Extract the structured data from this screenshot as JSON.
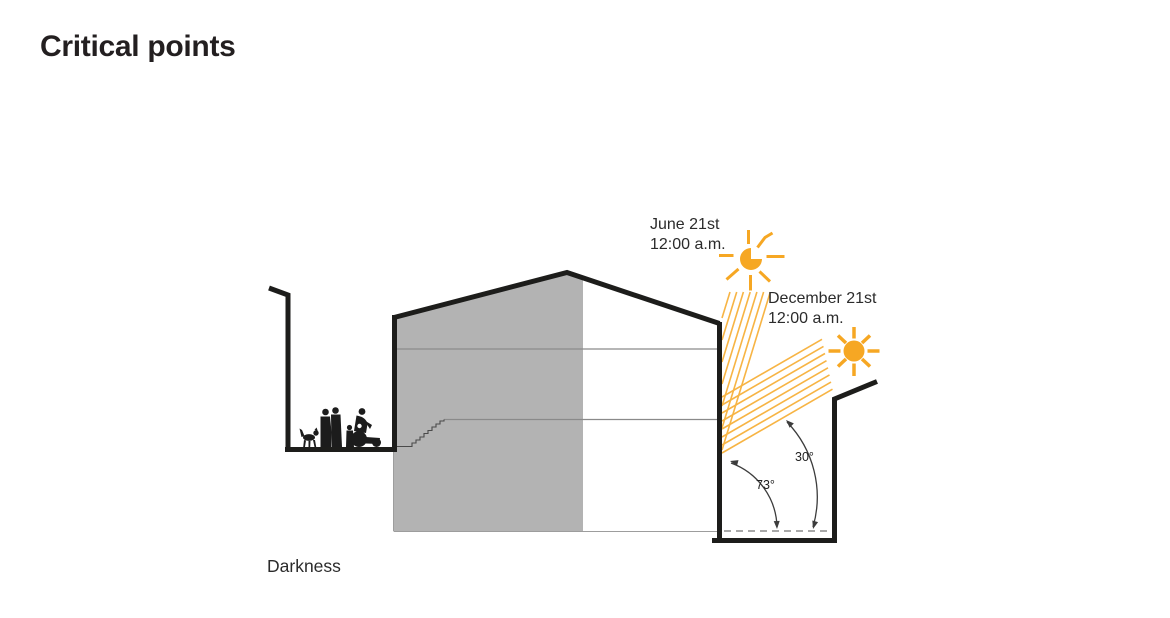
{
  "title": "Critical points",
  "sun_study": {
    "june": {
      "date": "June 21st",
      "time": "12:00 a.m.",
      "angle": "73°"
    },
    "december": {
      "date": "December 21st",
      "time": "12:00 a.m.",
      "angle": "30°"
    }
  },
  "darkness_label": "Darkness",
  "icons": {
    "june_sun": "sun-icon",
    "december_sun": "sun-icon"
  },
  "colors": {
    "sun": "#f6a723",
    "ray": "#f7b444",
    "ink": "#1d1d1b",
    "panel": "#b3b3b3",
    "thin": "#8a8a8a",
    "title": "#231f20",
    "text": "#2b2b2b"
  }
}
